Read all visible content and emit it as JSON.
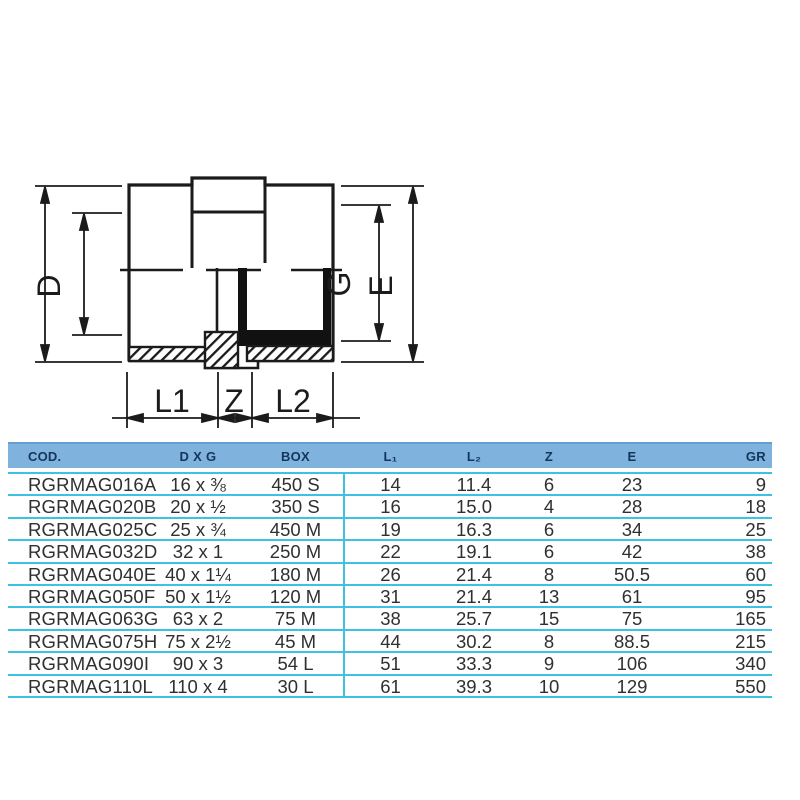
{
  "drawing": {
    "dimension_labels": {
      "e_left": "E",
      "d": "D",
      "g": "G",
      "e_right": "E",
      "l1": "L1",
      "z": "Z",
      "l2": "L2"
    }
  },
  "table": {
    "headers": [
      "COD.",
      "D X G",
      "BOX",
      "L₁",
      "L₂",
      "Z",
      "E",
      "GR"
    ],
    "rows": [
      [
        "RGRMAG016A",
        "16 x ⅜",
        "450 S",
        "14",
        "11.4",
        "6",
        "23",
        "9"
      ],
      [
        "RGRMAG020B",
        "20 x ½",
        "350 S",
        "16",
        "15.0",
        "4",
        "28",
        "18"
      ],
      [
        "RGRMAG025C",
        "25 x ¾",
        "450 M",
        "19",
        "16.3",
        "6",
        "34",
        "25"
      ],
      [
        "RGRMAG032D",
        "32 x 1",
        "250 M",
        "22",
        "19.1",
        "6",
        "42",
        "38"
      ],
      [
        "RGRMAG040E",
        "40 x 1¼",
        "180 M",
        "26",
        "21.4",
        "8",
        "50.5",
        "60"
      ],
      [
        "RGRMAG050F",
        "50 x 1½",
        "120 M",
        "31",
        "21.4",
        "13",
        "61",
        "95"
      ],
      [
        "RGRMAG063G",
        "63 x 2",
        "75 M",
        "38",
        "25.7",
        "15",
        "75",
        "165"
      ],
      [
        "RGRMAG075H",
        "75 x 2½",
        "45 M",
        "44",
        "30.2",
        "8",
        "88.5",
        "215"
      ],
      [
        "RGRMAG090I",
        "90 x 3",
        "54 L",
        "51",
        "33.3",
        "9",
        "106",
        "340"
      ],
      [
        "RGRMAG110L",
        "110 x 4",
        "30 L",
        "61",
        "39.3",
        "10",
        "129",
        "550"
      ]
    ],
    "colors": {
      "header_bg": "#7FB2DC",
      "header_text": "#14355C",
      "separator": "#3EC1E2",
      "row_text": "#303030"
    }
  }
}
